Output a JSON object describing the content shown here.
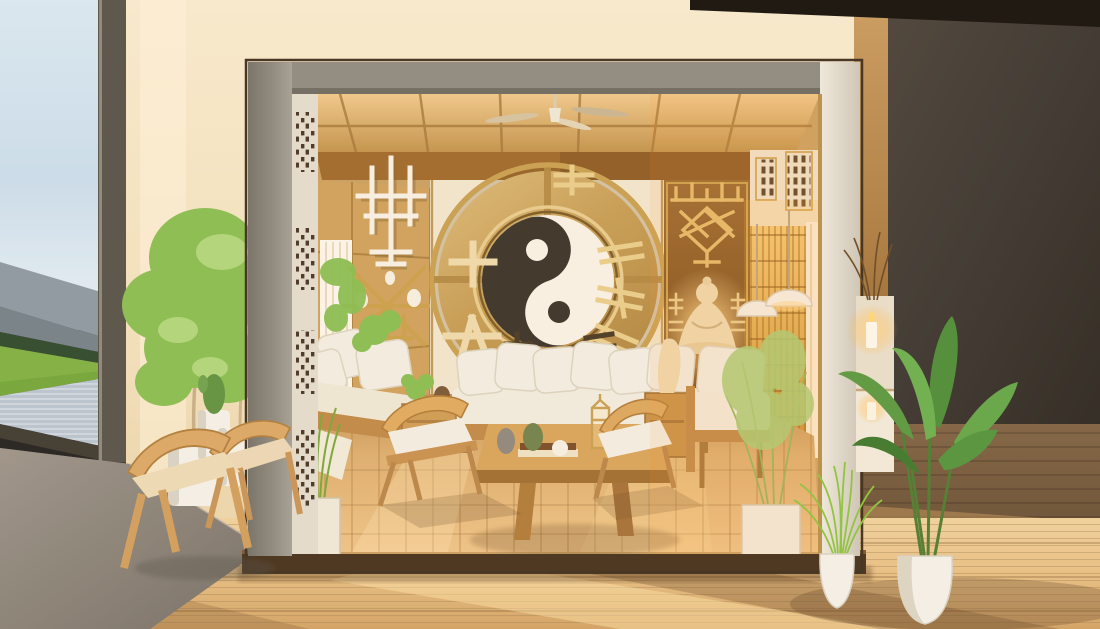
{
  "scene": {
    "kind": "zen-interior-render",
    "objects": [
      "window-view",
      "mountain-range",
      "treeline",
      "grass-field",
      "wood-deck",
      "display-box-room",
      "yin-yang-medallion",
      "trigram-marks",
      "buddha-statue",
      "ceiling-fan",
      "lattice-screen",
      "dome-pendant-lamps",
      "sectional-sofa",
      "coffee-table",
      "wooden-chairs",
      "potted-trees",
      "banana-plant",
      "fountain-grass",
      "planter-boxes",
      "candle-console",
      "area-rug"
    ]
  },
  "palette": {
    "sky": "#cfe4f2",
    "mountain_far": "#8e9aa6",
    "mountain_near": "#74828c",
    "treeline": "#2f4a2f",
    "grass": "#7fb245",
    "deck": "#b9c6d3",
    "window_frame": "#57544b",
    "window_base": "#3f3b33",
    "wall_cream": "#f4e7ca",
    "wall_tan": "#c89a5e",
    "wall_dark": "#3b3733",
    "ceiling_black": "#15120e",
    "frame_gray": "#8f8d84",
    "frame_cream": "#e3ded1",
    "plinth": "#46331f",
    "ceiling_wood": "#e2b877",
    "lintel": "#a06b2e",
    "wall_wood": "#cfa35f",
    "back_wall": "#f2e7d0",
    "gold": "#c9a254",
    "gold_bright": "#e9cf8e",
    "gold_deep": "#8a6a33",
    "panel_brown": "#8a5a28",
    "yin_dark": "#3a342b",
    "yang_light": "#f8f3e8",
    "cushion": "#f3efe4",
    "sofa_base": "#c08b4a",
    "wood_chair": "#dca96a",
    "floor_right": "#755d40",
    "rug": "#8e8880",
    "pot_white": "#f4f2ec",
    "plant_green": "#8abf54",
    "plant_dark": "#5f9442",
    "plant_bright": "#8cc63f",
    "glow": "#ffcf82",
    "statue": "#f0dcb4",
    "curtain": "#fbf7ee"
  }
}
